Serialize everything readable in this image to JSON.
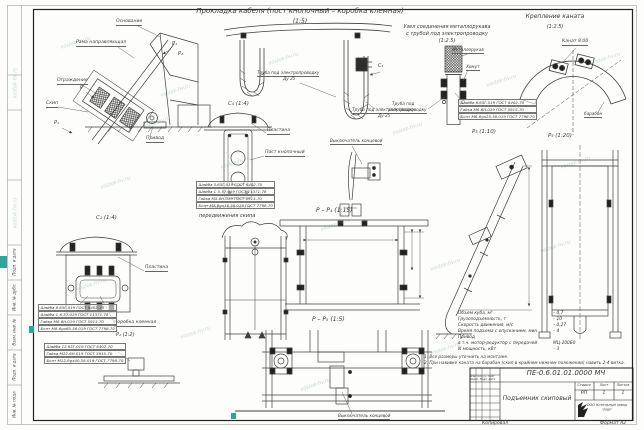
{
  "watermark": {
    "text": "vostok-hv.ru"
  },
  "page": {
    "copied": "Копировал",
    "format": "Формат А2"
  },
  "headings": {
    "cable_routing": "Прокладка кабеля (пост кнопочный – коробка клемная)",
    "cable_routing_scale": "(1:5)",
    "hose_unit_1": "Узел соединения металлорукава",
    "hose_unit_2": "с трубой под электропроводку",
    "hose_unit_scale": "(1:2.5)",
    "rope_fix": "Крепление каната",
    "rope_fix_scale": "(1:2.5)",
    "rope_scheme_1": "Схема канатного",
    "rope_scheme_2": "передвижения скипа"
  },
  "view_labels": {
    "c4": "С₄ (1:4)",
    "c1_marker": "С₁",
    "c_left": "С₁ (1:4)",
    "p3": "Р₃ (1:10)",
    "p5": "Р₅ (1:20)",
    "pp4": "Р – Р₄ (1:15)",
    "pp5": "Р – Р₅ (1:5)",
    "p2_small": "Р₂ (1:2)",
    "m_p1": "Р₁",
    "m_p2": "Р₂",
    "m_p4": "Р₄",
    "m_p": "Р"
  },
  "callouts": {
    "osnovanie": "Основание",
    "rama": "Рама направляющая",
    "ograzhdenie": "Ограждение",
    "skip": "Скип",
    "privod": "Привод",
    "plastina_top": "Пластина",
    "post_knop": "Пост кнопочный",
    "truba_1a": "Труба под электропроводку",
    "truba_1b": "Ду 25",
    "truba_2a": "Труба под электропроводку",
    "truba_2b": "Ду 25",
    "truba_3a": "Труба под",
    "truba_3b": "электропроводку",
    "metallorukav": "Металлорукав",
    "homut": "Хомут",
    "kanat": "Канат 8.00",
    "baraban": "барабан",
    "vykl_top": "Выключатель концевой",
    "vykl_bottom": "Выключатель концевой",
    "plastina_left": "Пластина",
    "korobka": "Коробка клемная"
  },
  "hardware": {
    "list_a": [
      "Шайба 5.65Г.019 ГОСТ 6402-70",
      "Шайба С 5.37.019 ГОСТ 11371-78",
      "Гайка М5-6Н.019 ГОСТ 5915-70",
      "Болт М5-6gх16.58.019 ГОСТ 7798-70"
    ],
    "list_b": [
      "Шайба 6.65Г.019 ГОСТ 6402-70",
      "Гайка М6-6Н.019 ГОСТ 5915-70",
      "Болт М6-6gх25.58.019 ГОСТ 7798-70"
    ],
    "list_c": [
      "Шайба 8.65Г.019 ГОСТ 6402-70",
      "Шайба С 8.37.019 ГОСТ 11371-78",
      "Гайка М8-6Н.019 ГОСТ 5915-70",
      "Болт М8-6gх60.58.019 ГОСТ 7798-70"
    ],
    "list_d": [
      "Шайба 12.65Г.019 ГОСТ 6402-70",
      "Гайка М12-6Н.019 ГОСТ 5915-70",
      "Болт М12-6gх40.58.019 ГОСТ 7798-70"
    ]
  },
  "specs": {
    "rows": [
      {
        "label": "Объем куба, м³",
        "value": "– 0,7"
      },
      {
        "label": "Грузоподъемность, т",
        "value": "– 10"
      },
      {
        "label": "Скорость движения, м/с",
        "value": "– 0,27"
      },
      {
        "label": "Время подъема с опусканием, мин",
        "value": "– 4"
      },
      {
        "label": "Привод",
        "value": ""
      },
      {
        "label": "в т.ч. мотор-редуктор с передачей",
        "value": "МЦ-200Б0"
      },
      {
        "label": "N мощность, кВт",
        "value": "– 3"
      }
    ]
  },
  "notes": [
    "1. Все размеры уточнить на монтаже.",
    "2. При навивке каната на барабан (скип в крайнем нижнем положении) навить 2-4 витка."
  ],
  "titleblock": {
    "doc_number": "ПЕ-0.6.01.01.0000 МЧ",
    "title": "Подъемник скиповый",
    "stage_label": "Стадия",
    "sheet_label": "Лист",
    "sheets_label": "Листов",
    "stage": "РП",
    "sheet": "1",
    "sheets": "1",
    "company_1": "ООО Котельный завод",
    "company_2": "\"РЭП\"",
    "change_row": "Изм. Кол.уч. Лист №док. Подп. Дата"
  },
  "side_strip": [
    "Инв. № подл.",
    "Подп. и дата",
    "Взам. инв. №",
    "Инв. № дубл.",
    "Подп. и дата"
  ]
}
